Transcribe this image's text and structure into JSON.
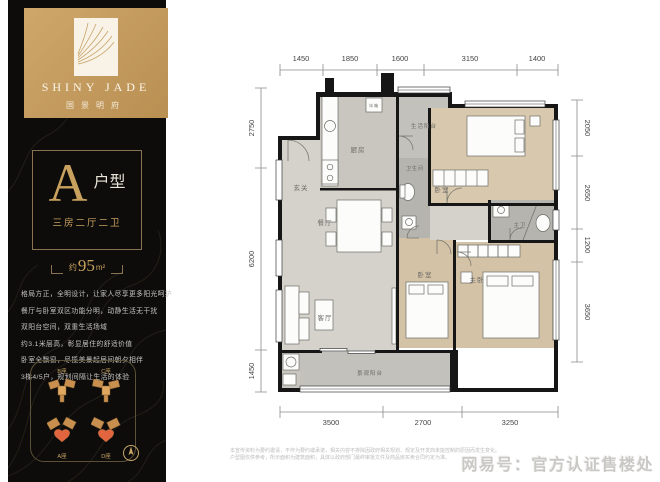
{
  "sidebar": {
    "logo": {
      "en": "SHINY JADE",
      "cn": "国景明府"
    },
    "unit_card": {
      "letter": "A",
      "type": "户型",
      "spec": "三房二厅二卫",
      "area_prefix": "约",
      "area_num": "95",
      "area_unit": "m²"
    },
    "description_lines": [
      "格局方正，全明设计，让家人尽享更多阳光呵护",
      "餐厅与卧室双区功能分明，动静生活无干扰",
      "双阳台空间，双重生活场域",
      "约3.1米层高，彰显居住的舒适价值",
      "卧室全飘窗，尽揽美景起居间朝夕相伴",
      "3梯4/5户，规划间隔让生活的体验"
    ],
    "sitemap": {
      "buildings": [
        "B座",
        "C座",
        "A座",
        "D座"
      ]
    }
  },
  "plan": {
    "rooms": {
      "entry": "玄关",
      "kitchen": "厨房",
      "service_balcony": "生活阳台",
      "guest_bath": "卫生间",
      "bedroom_a": "卧室",
      "dining": "餐厅",
      "living": "客厅",
      "bedroom_b": "卧室",
      "master_bedroom": "主卧",
      "master_bath": "主卫",
      "view_balcony": "景观阳台",
      "fridge": "冰箱"
    }
  },
  "dimensions": {
    "top": [
      "1450",
      "1850",
      "1600",
      "3150",
      "1400"
    ],
    "bottom": [
      "3500",
      "2700",
      "3250"
    ],
    "left": [
      "2750",
      "6200",
      "1450"
    ],
    "right": [
      "2050",
      "2650",
      "1200",
      "3650"
    ]
  },
  "footer": {
    "disclaimer_line1": "本宣传资料为要约邀请，不作为要约或承诺，相关内容不排除因政府相关规划、规定及开发商未能控制的原因而发生变化。",
    "disclaimer_line2": "户型图仅供参考，所示面积为建筑面积，具体以政府部门最终审批文件及商品房买卖合同约定为准。",
    "watermark": "网易号：官方认证售楼处"
  },
  "colors": {
    "brand_gold": "#c9a15e",
    "panel_black": "#0d0c0a",
    "wall": "#161616",
    "wood_floor": "#d3c2a6",
    "tile_floor": "#b6b4af",
    "marble_floor": "#d5d2cc"
  }
}
